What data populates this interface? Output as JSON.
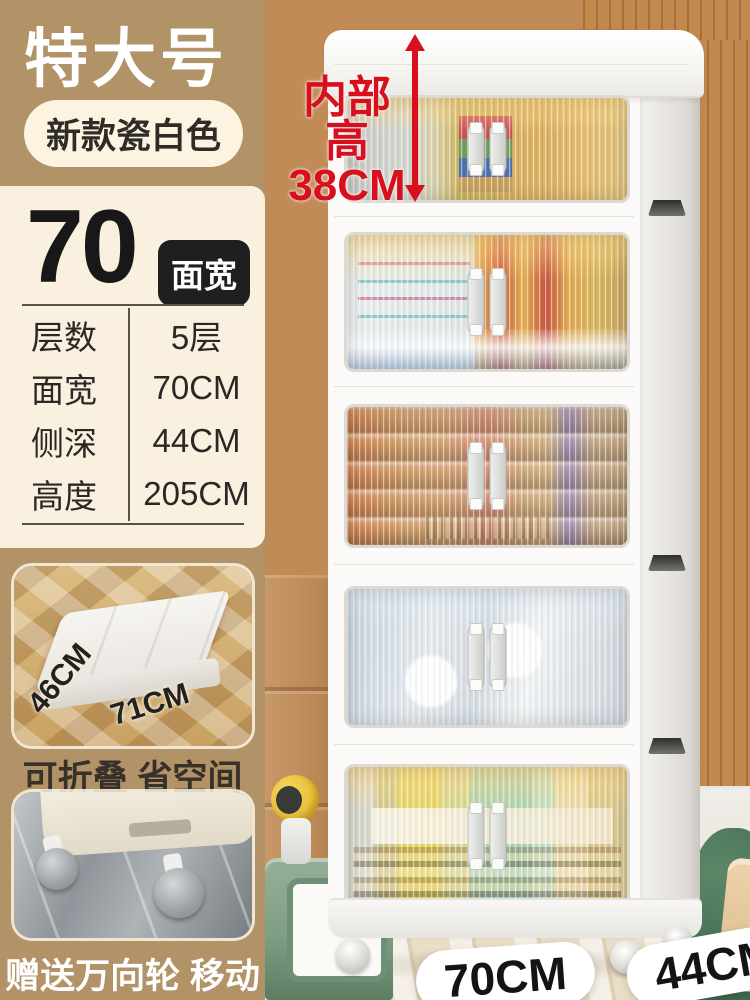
{
  "header": {
    "size_tag": "特大号",
    "color_tag": "新款瓷白色"
  },
  "spec": {
    "width_number": "70",
    "width_unit_badge": "面宽",
    "rows": [
      {
        "label": "层数",
        "value": "5层"
      },
      {
        "label": "面宽",
        "value": "70CM"
      },
      {
        "label": "侧深",
        "value": "44CM"
      },
      {
        "label": "高度",
        "value": "205CM"
      }
    ]
  },
  "fold_feature": {
    "depth_label": "46CM",
    "width_label": "71CM",
    "caption": "可折叠 省空间"
  },
  "wheel_feature": {
    "caption": "赠送万向轮 移动省力"
  },
  "product_annotations": {
    "inner_height_prefix": "内部高",
    "inner_height_value": "38CM",
    "front_width": "70CM",
    "side_depth": "44CM"
  },
  "colors": {
    "accent_red": "#d8101d",
    "brand_tan": "#b19367",
    "panel_cream": "#faf0e0",
    "badge_dark": "#1f1f1f"
  }
}
